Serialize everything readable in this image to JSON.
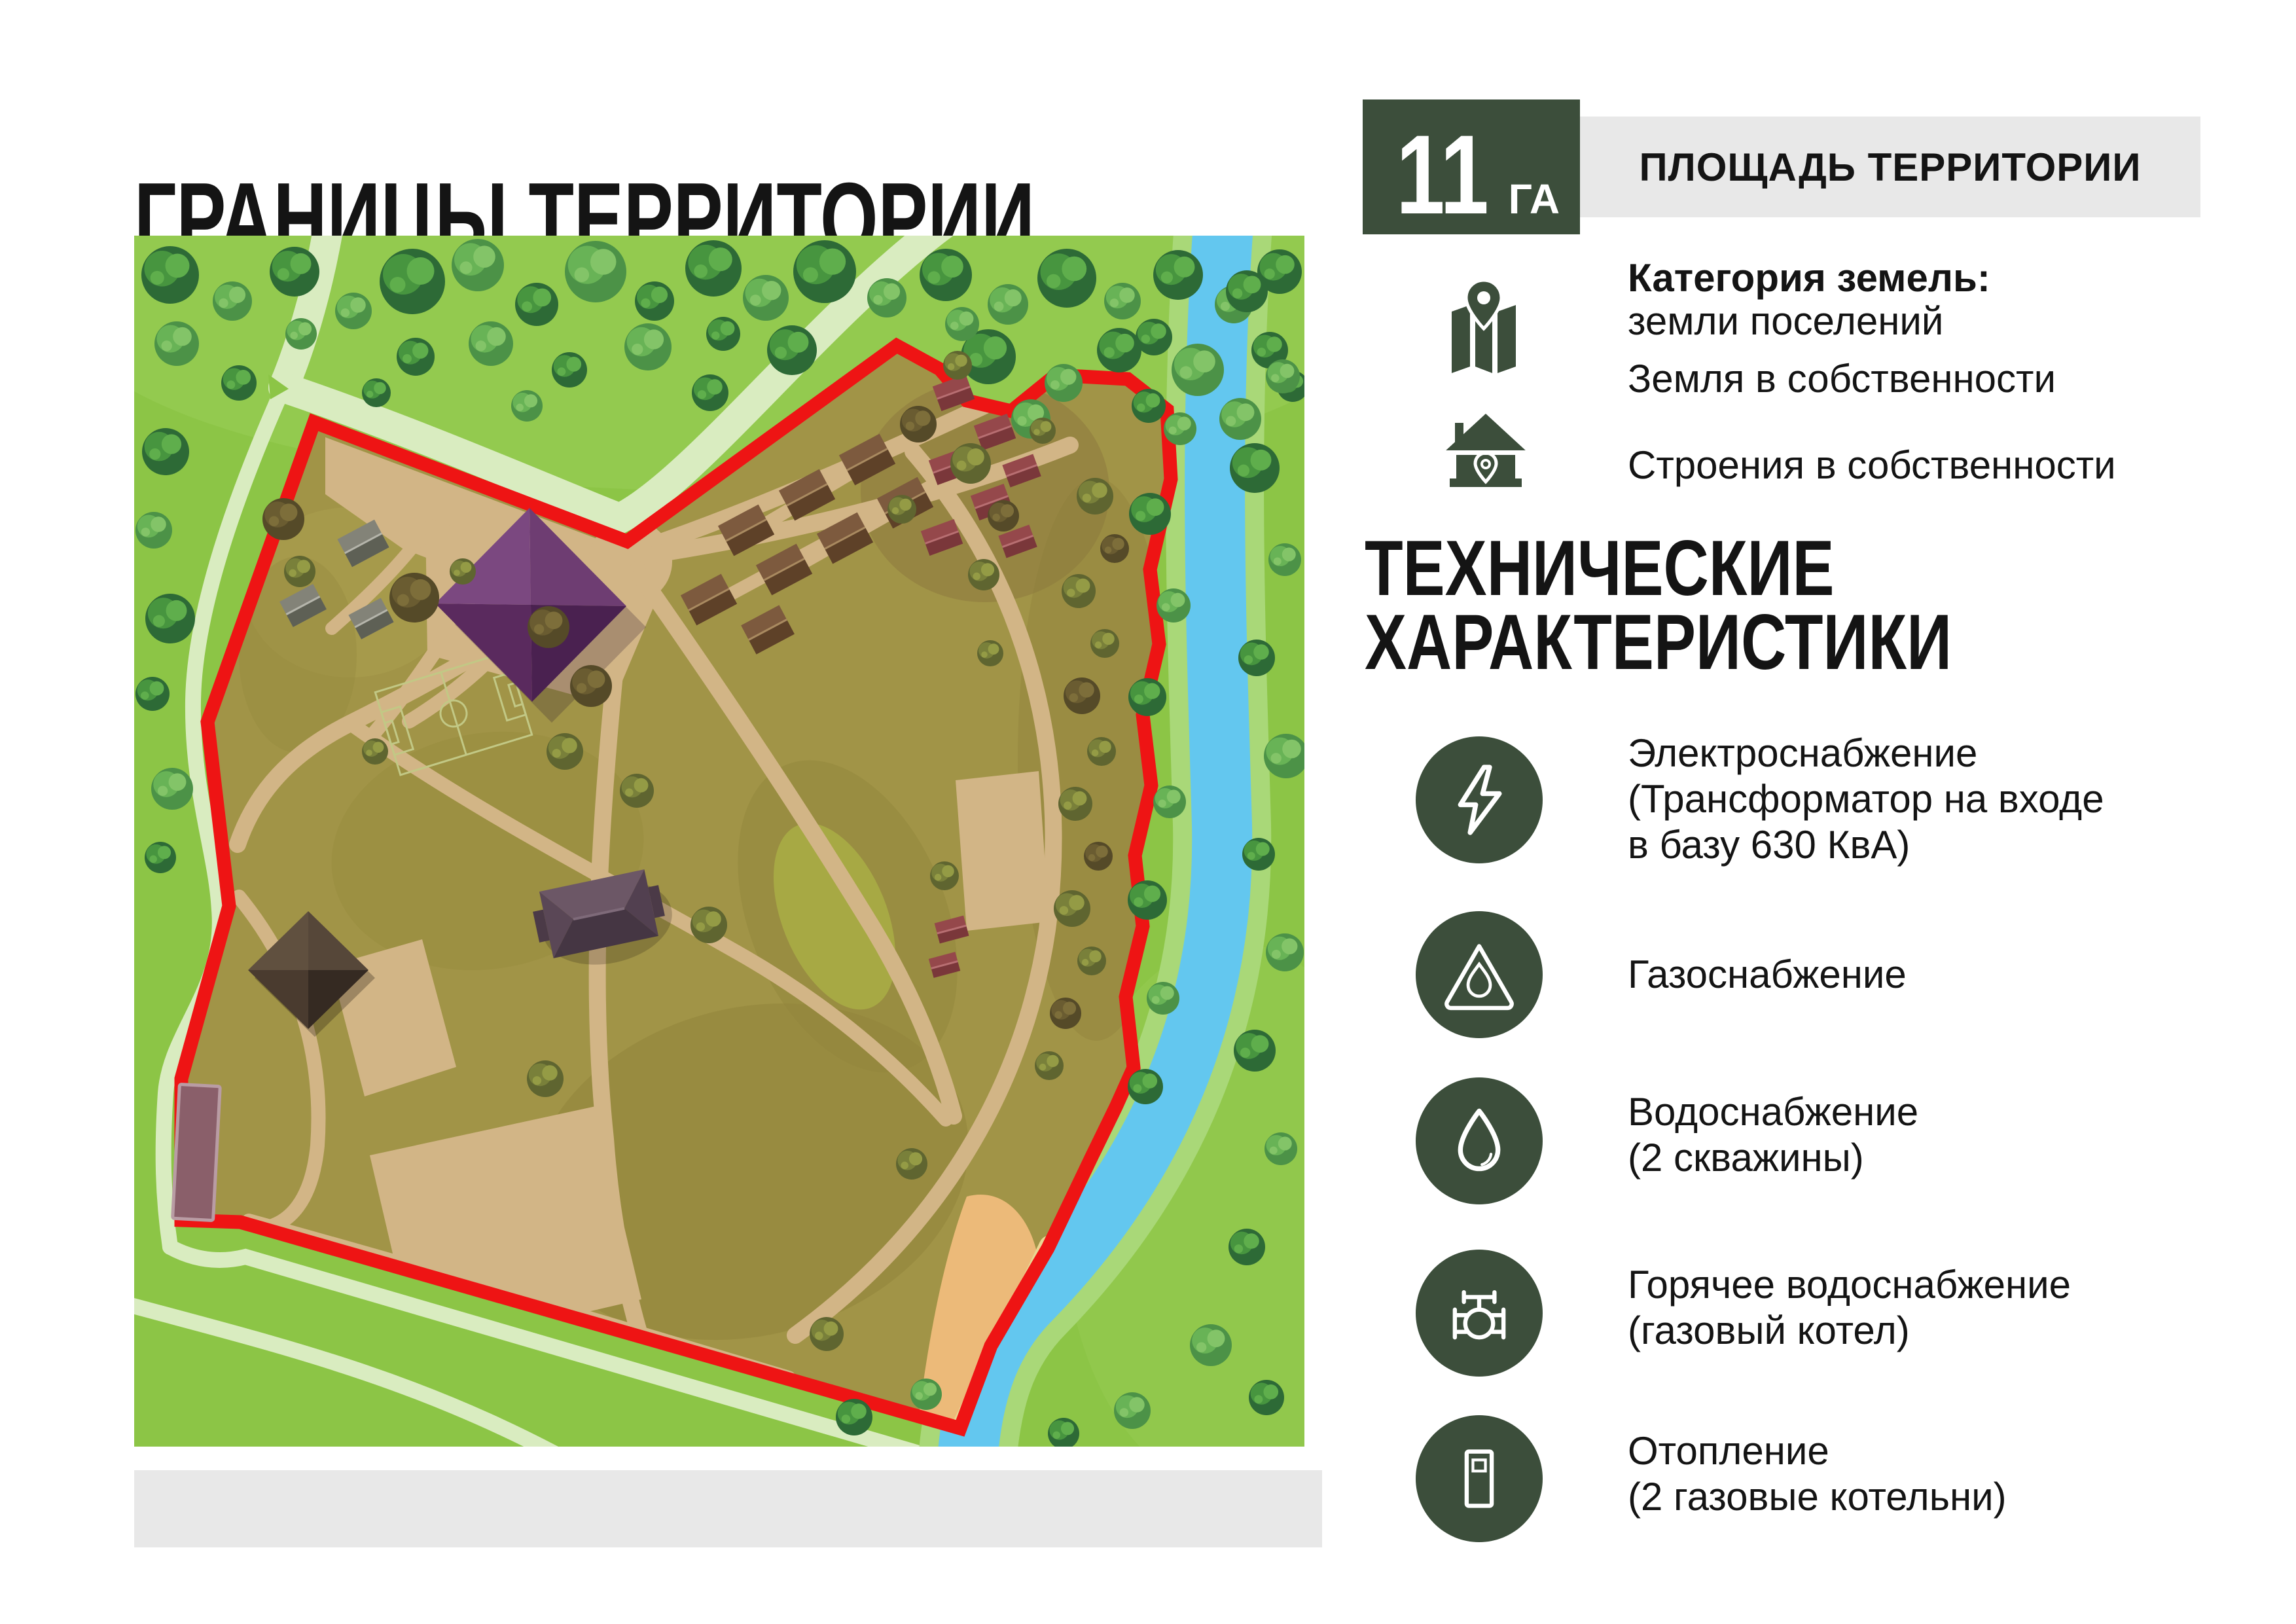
{
  "page": {
    "title": "ГРАНИЦЫ ТЕРРИТОРИИ"
  },
  "area": {
    "value": "11",
    "unit": "ГА",
    "label": "ПЛОЩАДЬ ТЕРРИТОРИИ"
  },
  "land": {
    "category_label": "Категория земель:",
    "category_value": "земли поселений",
    "land_ownership": "Земля в собственности",
    "buildings_ownership": "Строения в собственности"
  },
  "tech": {
    "heading": [
      "ТЕХНИЧЕСКИЕ",
      "ХАРАКТЕРИСТИКИ"
    ],
    "items": [
      {
        "icon": "lightning-icon",
        "lines": [
          "Электроснабжение",
          "(Трансформатор на входе",
          "в базу 630 КвА)"
        ]
      },
      {
        "icon": "gas-flame-icon",
        "lines": [
          "Газоснабжение"
        ]
      },
      {
        "icon": "water-drop-icon",
        "lines": [
          "Водоснабжение",
          "(2 скважины)"
        ]
      },
      {
        "icon": "valve-icon",
        "lines": [
          "Горячее водоснабжение",
          "(газовый котел)"
        ]
      },
      {
        "icon": "boiler-icon",
        "lines": [
          "Отопление",
          "(2 газовые котельни)"
        ]
      }
    ]
  },
  "map": {
    "description": "territory plan with red boundary, river and buildings",
    "boundary_color": "#ee1414",
    "river_color": "#63c7ef",
    "grass_color": "#8cc546",
    "territory_color": "#a19447",
    "accent_dark_green": "#3c4e3b",
    "panel_gray": "#e8e8e8"
  }
}
